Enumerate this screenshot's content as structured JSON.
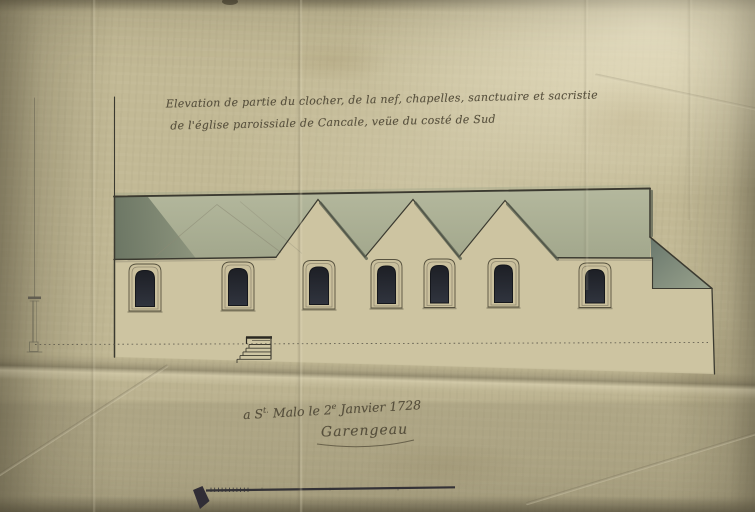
{
  "document": {
    "title_line1": "Elevation de partie du clocher, de la nef, chapelles, sanctuaire et sacristie",
    "title_line2": "de l'église paroissiale de Cancale, veüe du costé de Sud",
    "date_parts": {
      "p1": "a S",
      "s1": "t.",
      "p2": " Malo le 2",
      "s2": "e",
      "p3": " Janvier 1728"
    },
    "signature": "Garengeau"
  },
  "drawing": {
    "subject": "South elevation of parish church: part of bell tower, nave, chapels, sanctuary and sacristy",
    "window_count": 7,
    "chapel_gable_count": 3,
    "colors": {
      "paper": "#c2b995",
      "wall": "#cdc4a1",
      "roof_wash": "#a9ae94",
      "roof_shadow": "#6f7b6e",
      "window_glass": "#23262c",
      "ink_line": "#3b3a30",
      "ink_text": "#4f4836"
    }
  }
}
